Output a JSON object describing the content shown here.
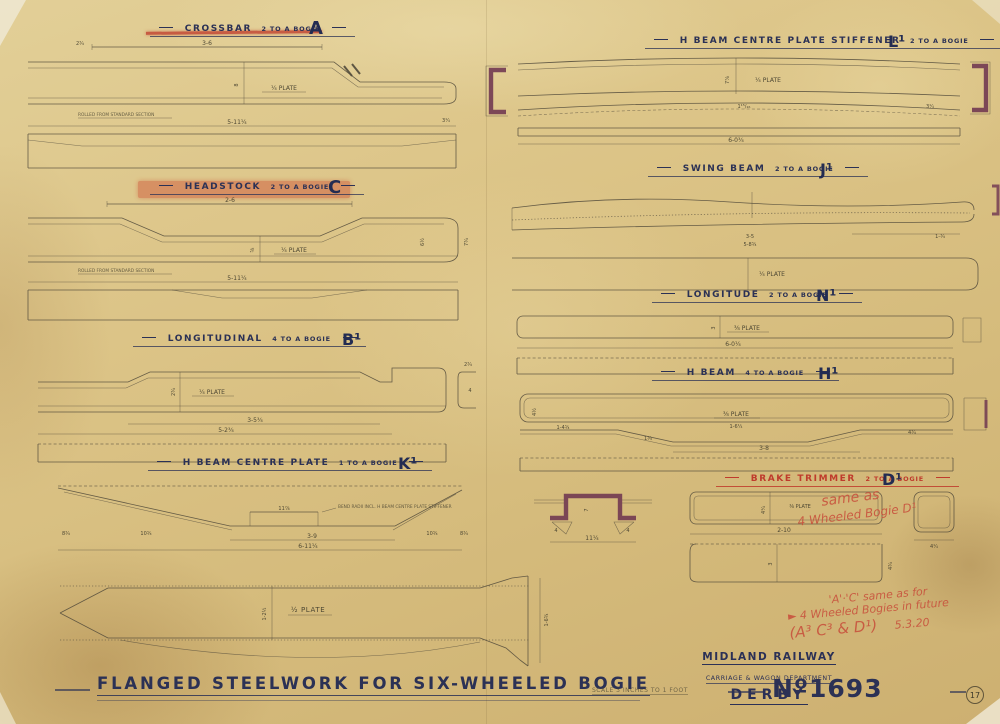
{
  "sections": {
    "crossbar": {
      "title": "CROSSBAR",
      "qty": "2 TO A BOGIE",
      "code": "A",
      "plate": "¼ PLATE",
      "dim_top": "3-6",
      "dim_top_small": "2¾",
      "dim_depth": "8",
      "dim_bottom": "5-11¼",
      "dim_end": "3¼",
      "note": "ROLLED FROM STANDARD SECTION"
    },
    "stiffener": {
      "title": "H BEAM CENTRE PLATE STIFFENER",
      "qty": "2 TO A BOGIE",
      "code": "L¹",
      "plate": "¼ PLATE",
      "dim_depth": "7⅞",
      "dim_mid": "1¹⁵/₁₆",
      "dim_bottom": "6-0¾",
      "dim_end": "3¼"
    },
    "headstock": {
      "title": "HEADSTOCK",
      "qty": "2 TO A BOGIE",
      "code": "C",
      "plate": "¼ PLATE",
      "dim_top": "2-6",
      "dim_depth": "⅝",
      "dim_right1": "6½",
      "dim_right2": "7¾",
      "dim_bottom": "5-11¼",
      "note": "ROLLED FROM STANDARD SECTION"
    },
    "swing_beam": {
      "title": "SWING BEAM",
      "qty": "2 TO A BOGIE",
      "code": "J¹",
      "plate": "¼ PLATE",
      "dim1": "3-5",
      "dim2": "5-8¾",
      "dim_end": "1-¾"
    },
    "longitude": {
      "title": "LONGITUDE",
      "qty": "2 TO A BOGIE",
      "code": "N¹",
      "plate": "⅜ PLATE",
      "dim_depth": "3",
      "dim_bottom": "6-0¼"
    },
    "longitudinal": {
      "title": "LONGITUDINAL",
      "qty": "4 TO A BOGIE",
      "code": "B¹",
      "plate": "¼ PLATE",
      "dim_depth": "2¾",
      "dim1": "3-5¾",
      "dim2": "5-2¾",
      "sec_w": "2¾",
      "sec_h": "4"
    },
    "hbeam": {
      "title": "H BEAM",
      "qty": "4 TO A BOGIE",
      "code": "H¹",
      "plate": "⅜ PLATE",
      "dim_left_v": "4½",
      "dim_left": "1-4¾",
      "dim_mid": "1-6¼",
      "dim_span": "3-8",
      "dim_right": "4¾",
      "dim_slope": "1¾"
    },
    "centre_plate": {
      "title": "H BEAM CENTRE PLATE",
      "qty": "1 TO A BOGIE",
      "code": "K¹",
      "note": "BEND RADII INCL. H BEAM CENTRE PLATE STIFFENER",
      "dim_plateau": "11⅞",
      "dim_flat": "3-9",
      "dim_overall": "6-11¼",
      "dim_slope_l": "10¾",
      "dim_slope_r": "10¾",
      "dim_end_l": "8¾",
      "dim_end_r": "8¾",
      "plate": "½ PLATE",
      "dim_v1": "1-2½",
      "dim_v2": "1-6¾"
    },
    "tophat": {
      "dim_w": "11¼",
      "dim_f1": "4",
      "dim_f2": "4",
      "dim_h": "7"
    },
    "brake_trimmer": {
      "title": "BRAKE TRIMMER",
      "qty": "2 TO A BOGIE",
      "code": "D¹",
      "plate": "⅜ PLATE",
      "dim_v1": "4¼",
      "dim_bottom": "2-10",
      "dim_v2": "3",
      "dim_end": "4¾",
      "sec_dim1": "4¼"
    }
  },
  "red_notes": {
    "brake_line1": "same as",
    "brake_line2": "4 Wheeled Bogie D¹",
    "main_line1": "'A'·'C' same as for",
    "main_line2": "► 4 Wheeled Bogies in future",
    "main_line3": "(A³ C³ & D¹)",
    "main_date": "5.3.20"
  },
  "footer": {
    "title": "FLANGED STEELWORK FOR SIX-WHEELED BOGIE",
    "scale_note": "SCALE 3 INCHES TO 1 FOOT",
    "number": "Nº1693",
    "sheet": "17",
    "stamp_line1": "MIDLAND RAILWAY",
    "stamp_line2": "CARRIAGE & WAGON DEPARTMENT",
    "stamp_line3": "DERBY"
  },
  "colors": {
    "paper": "#d9c183",
    "ink": "#50493a",
    "title_ink": "#2b3155",
    "red": "#bf3b2c",
    "maroon": "#6e3550",
    "hand_red": "#c8503c"
  }
}
